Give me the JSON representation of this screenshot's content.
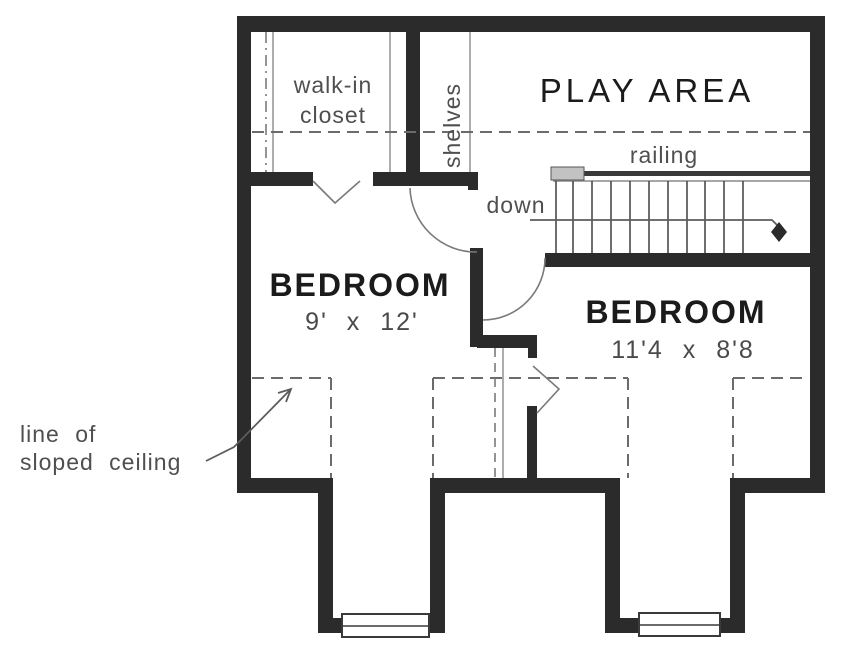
{
  "plan": {
    "walk_in_closet": {
      "line1": "walk-in",
      "line2": "closet"
    },
    "shelves_label": "shelves",
    "play_area_label": "PLAY AREA",
    "stairs": {
      "railing_label": "railing",
      "down_label": "down",
      "tread_lines": 11,
      "direction": "down"
    },
    "bedroom_left": {
      "name": "BEDROOM",
      "size": "9' x 12'"
    },
    "bedroom_right": {
      "name": "BEDROOM",
      "size": "11'4 x 8'8"
    },
    "sloped_ceiling_note": {
      "line1": "line of",
      "line2": "sloped ceiling"
    },
    "colors": {
      "wall": "#2b2b2b",
      "thin_line": "#6e6e6e",
      "dashed_line": "#6b6b6b",
      "text_dark": "#1b1b1b",
      "text_gray": "#4f4f4f",
      "railing_cap": "#c2c2c2",
      "background": "#ffffff"
    }
  }
}
